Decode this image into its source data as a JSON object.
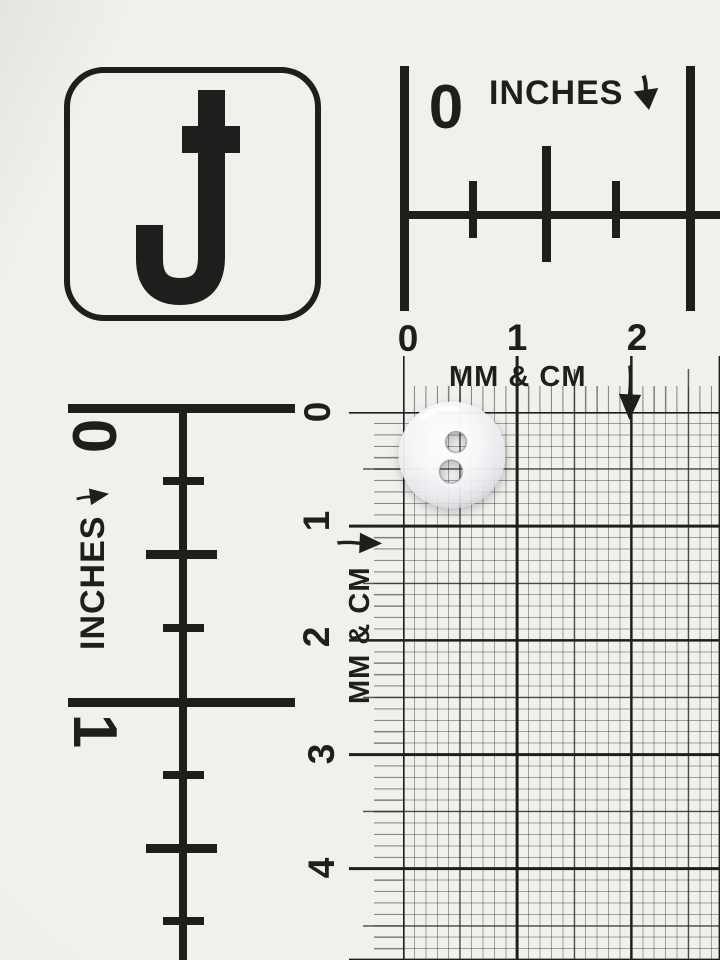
{
  "scene": {
    "description": "Photograph of a white photographer's measurement reference card with inch rulers and a millimeter/centimeter grid; a small translucent white two-hole sewing button lies on the grid",
    "paper_color": "#f1f0ed",
    "ink_color": "#1f1e1c",
    "grid_minor_line_color": "#9a9a98",
    "grid_major_line_color": "#1f1e1c"
  },
  "logo": {
    "letter": "J",
    "style": "capital J with cross bar inside rounded square frame"
  },
  "inches_top": {
    "zero": "0",
    "label": "INCHES",
    "arrow": "down",
    "ticks": [
      "0",
      "1/4",
      "1/2",
      "3/4",
      "1"
    ]
  },
  "inches_left": {
    "zero": "0",
    "one": "1",
    "label": "INCHES",
    "arrow": "right",
    "ticks": [
      "0",
      "1/4",
      "1/2",
      "3/4",
      "1",
      "1 1/4",
      "1 1/2",
      "1 3/4"
    ]
  },
  "metric_grid": {
    "top_numbers": [
      "0",
      "1",
      "2"
    ],
    "left_numbers": [
      "0",
      "1",
      "2",
      "3",
      "4"
    ],
    "top_label": "MM & CM",
    "left_label": "MM & CM",
    "top_arrow": "down",
    "left_arrow": "right",
    "unit": "millimeter squares with bold lines every centimeter"
  },
  "button": {
    "description": "translucent white round button with two holes, grid visible through holes",
    "hole_count": 2,
    "approx_diameter_mm": 9,
    "color": "#f8f8fa"
  }
}
